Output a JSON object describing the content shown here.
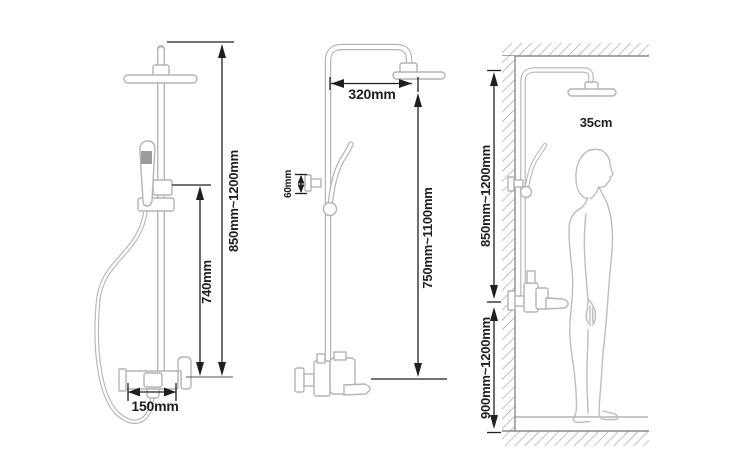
{
  "colors": {
    "background": "#ffffff",
    "fixture_line": "#b4b4b4",
    "dimension_line": "#1f1f1f",
    "label_text": "#1f1f1f",
    "sprayer_face": "#9c9c9c",
    "hatch_line": "#9a9a9a"
  },
  "left_figure": {
    "dims": {
      "overall_height": "850mm~1200mm",
      "riser_height": "740mm",
      "valve_width": "150mm"
    }
  },
  "middle_figure": {
    "dims": {
      "arm_reach": "320mm",
      "bracket_offset": "60mm",
      "column_height": "750mm~1100mm"
    }
  },
  "right_figure": {
    "dims": {
      "head_clearance": "35cm",
      "upper_section_height": "850mm~1200mm",
      "valve_height_from_floor": "900mm~1200mm"
    }
  }
}
